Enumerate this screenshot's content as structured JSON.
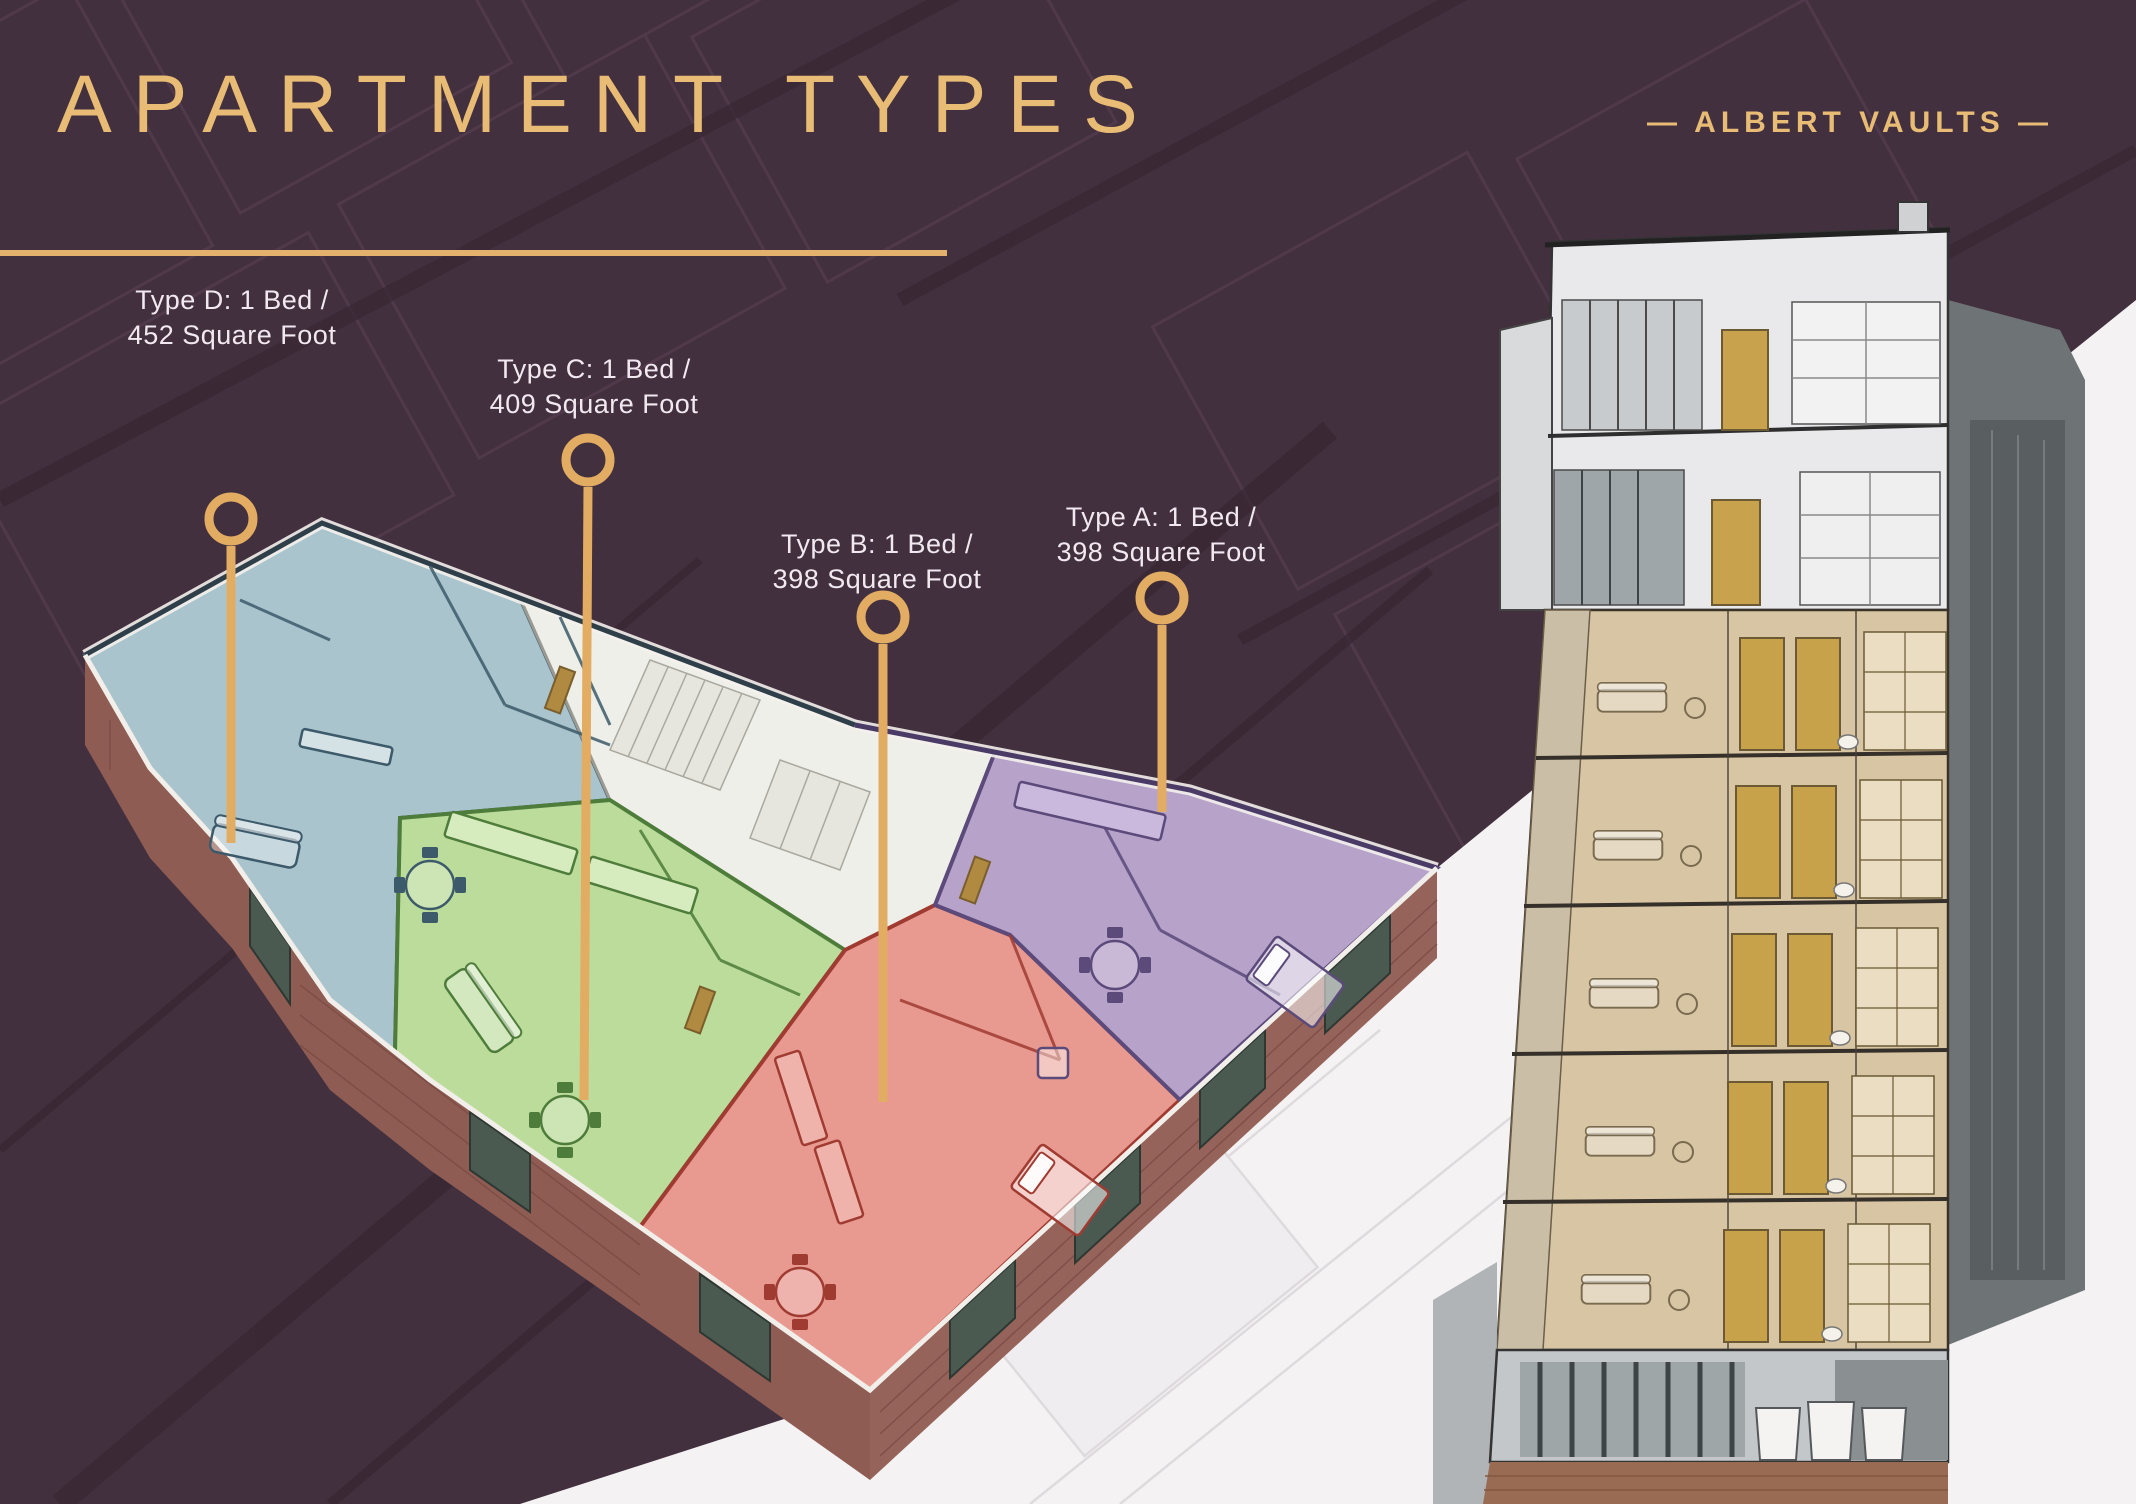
{
  "slide": {
    "title": "APARTMENT TYPES",
    "brand": "— ALBERT VAULTS —"
  },
  "callouts": [
    {
      "id": "type-d",
      "line1": "Type D: 1 Bed /",
      "line2": "452 Square Foot",
      "unit_color": "#A9C4CD"
    },
    {
      "id": "type-c",
      "line1": "Type C: 1 Bed /",
      "line2": "409 Square Foot",
      "unit_color": "#BCDC9C"
    },
    {
      "id": "type-b",
      "line1": "Type B: 1 Bed /",
      "line2": "398 Square Foot",
      "unit_color": "#E99A90"
    },
    {
      "id": "type-a",
      "line1": "Type A: 1 Bed /",
      "line2": "398 Square Foot",
      "unit_color": "#B7A2CA"
    }
  ],
  "colors": {
    "background_maroon": "#43303F",
    "accent_gold": "#E4B26C",
    "title_gold": "#E8BC74",
    "label_text": "#F2E9F0",
    "type_a_purple": "#B7A2CA",
    "type_b_red": "#E99A90",
    "type_c_green": "#BCDC9C",
    "type_d_blue": "#A9C4CD",
    "stairwell_white": "#EFEFE9",
    "brick": "#8E5C52",
    "section_highlight_tan": "#D8C5A3",
    "backdrop_white": "#F4F2F3"
  }
}
